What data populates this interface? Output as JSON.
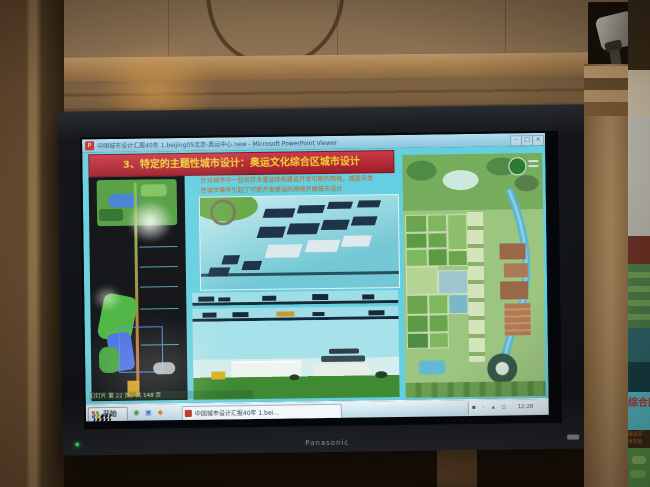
{
  "tv": {
    "brand_logo": "Panasonic"
  },
  "screen": {
    "titlebar": {
      "title": "中国城市设计汇报40年 1.beijing05北京-奥运中心.new - Microsoft PowerPoint Viewer",
      "buttons": {
        "minimize": "–",
        "maximize": "□",
        "close": "×"
      }
    },
    "slide": {
      "heading": "3、特定的主题性城市设计：奥运文化综合区城市设计",
      "paragraph_line1": "针对城市中一些尚存多重选择和建设开发可能的用地，或是突发",
      "paragraph_line2": "性城市事件引起了可能开发建设的用地开展城市设计"
    },
    "osd_text": "幻灯片 第 22 页，共 148 页",
    "taskbar": {
      "start_label": "开始",
      "task_button_label": "中国城市设计汇报40年 1.bei...",
      "clock": "12:28"
    }
  },
  "side_screen": {
    "heading_fragment": "综合区城市设计",
    "paragraph_fragment": "建设开发可能的用地开展城市设计"
  },
  "icons": {
    "powerpoint_doc": "P",
    "quick_1": "◉",
    "quick_2": "▣",
    "quick_3": "◆",
    "tray_1": "▪",
    "tray_2": "◦",
    "tray_3": "▴",
    "tray_4": "▫"
  },
  "colors": {
    "slide_bg": "#63cfe0",
    "heading_bg": "#b52e3a",
    "heading_text": "#f2d435",
    "paragraph_text": "#c4601a",
    "taskbar_bg": "#cfe9f2",
    "plan_green": "#9cc580",
    "river_blue": "#58b2d8",
    "tv_bezel": "#16181d",
    "wall_wood": "#8b7152"
  }
}
